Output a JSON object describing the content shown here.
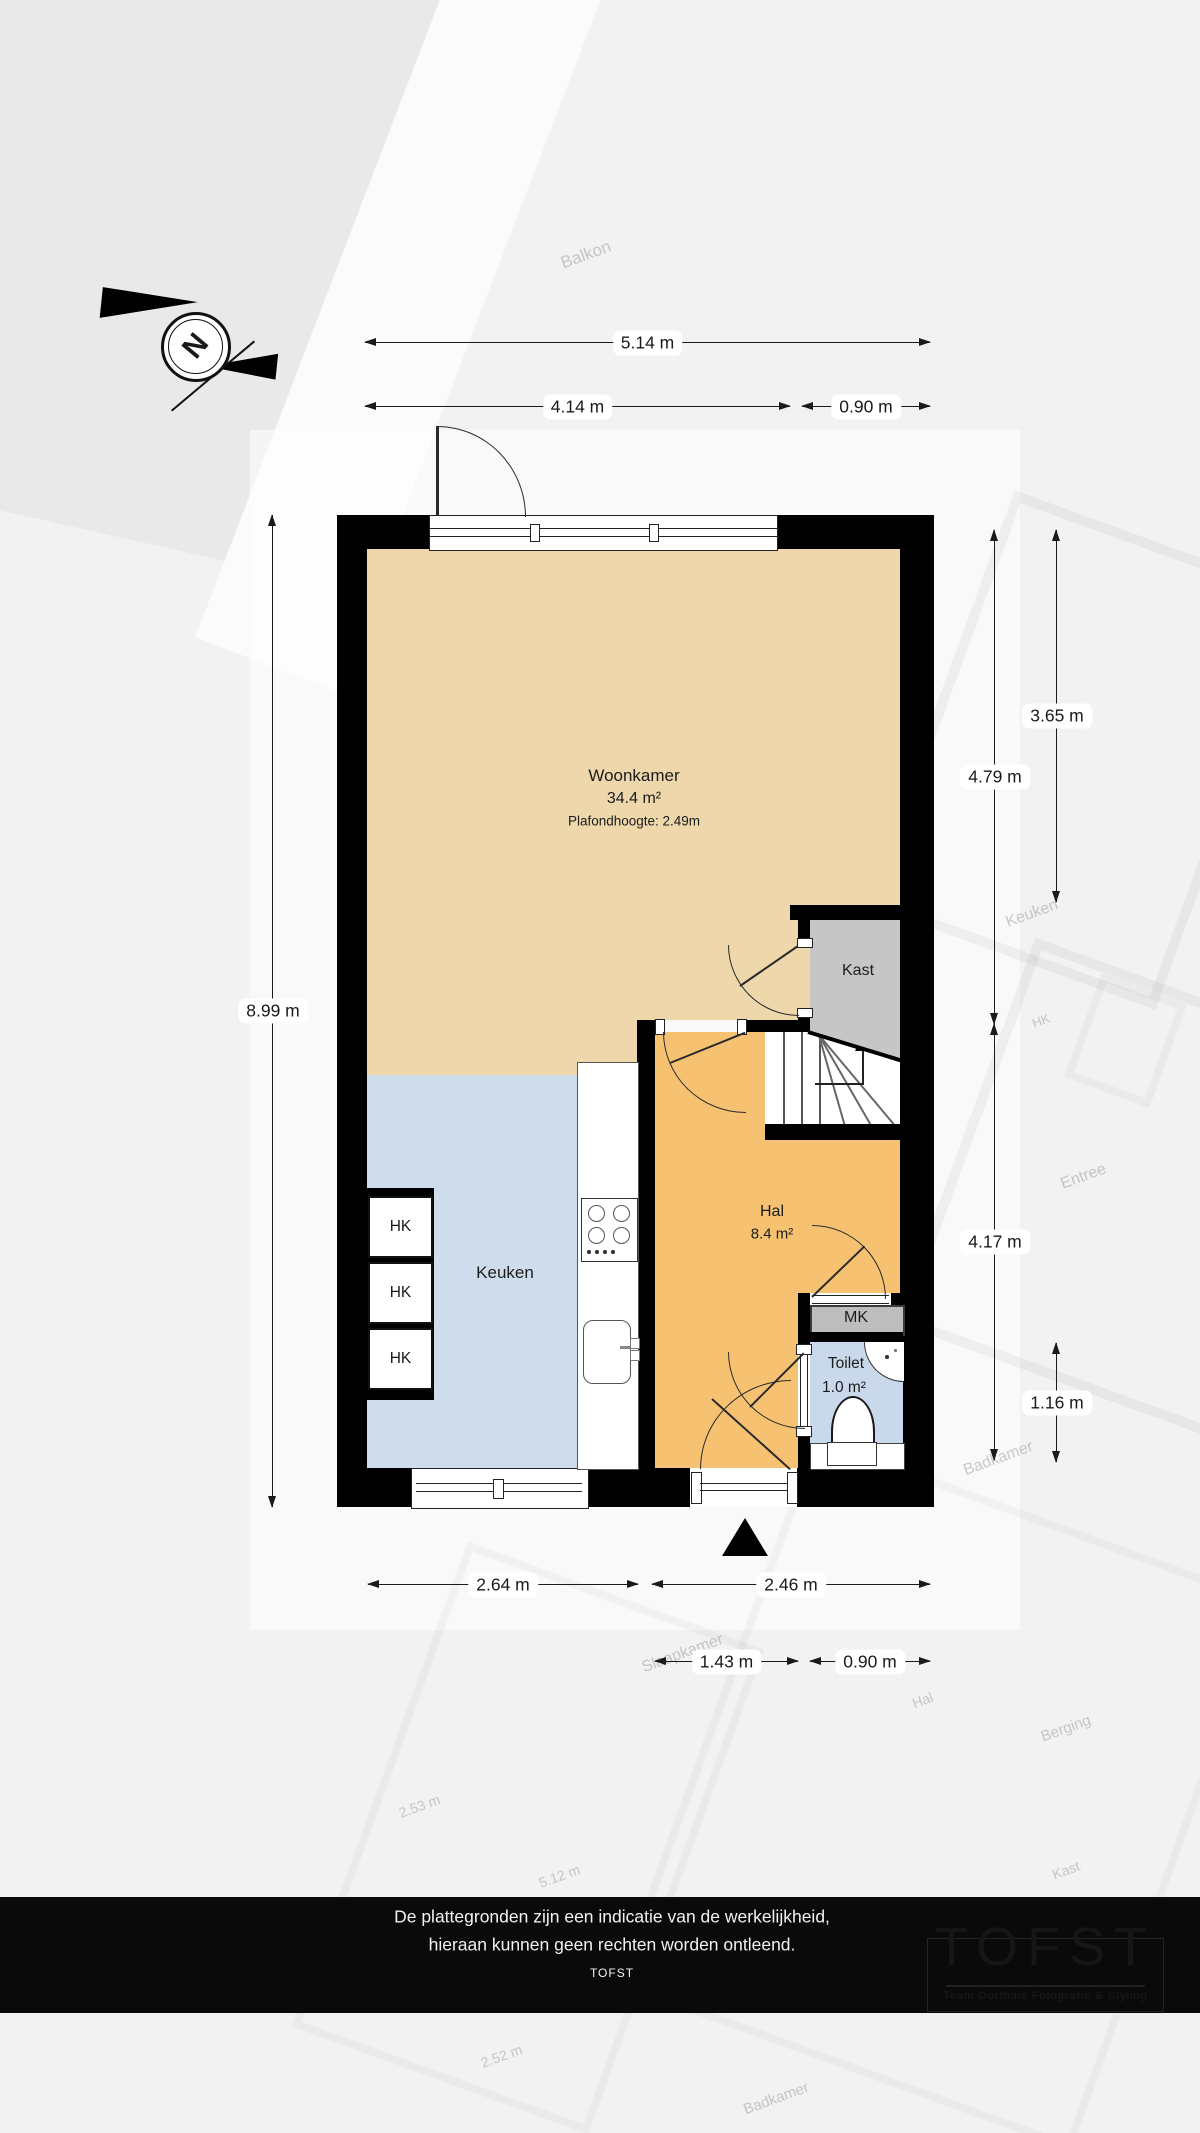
{
  "compass": {
    "north_letter": "N"
  },
  "plan": {
    "rooms": {
      "woonkamer": {
        "name": "Woonkamer",
        "area": "34.4 m²",
        "ceiling": "Plafondhoogte: 2.49m"
      },
      "kast": {
        "name": "Kast"
      },
      "keuken": {
        "name": "Keuken"
      },
      "hal": {
        "name": "Hal",
        "area": "8.4 m²"
      },
      "toilet": {
        "name": "Toilet",
        "area": "1.0 m²"
      },
      "mk": {
        "name": "MK"
      },
      "hk": {
        "name": "HK"
      }
    },
    "dimensions": {
      "width_total": "5.14 m",
      "width_window": "4.14 m",
      "width_door_top": "0.90 m",
      "height_total": "8.99 m",
      "height_woonkamer": "4.79 m",
      "height_right_upper": "3.65 m",
      "height_hal": "4.17 m",
      "height_toilet": "1.16 m",
      "width_keuken": "2.64 m",
      "width_hal": "2.46 m",
      "width_entry": "1.43 m",
      "width_door_bottom": "0.90 m"
    }
  },
  "background": {
    "labels": [
      {
        "text": "Balkon"
      },
      {
        "text": "Keuken"
      },
      {
        "text": "HK"
      },
      {
        "text": "Entree"
      },
      {
        "text": "Badkamer"
      },
      {
        "text": "Slaapkamer"
      },
      {
        "text": "Hal"
      },
      {
        "text": "Berging"
      },
      {
        "text": "Kast"
      },
      {
        "text": "2.53 m"
      },
      {
        "text": "5.12 m"
      },
      {
        "text": "2.52 m"
      },
      {
        "text": "Badkamer"
      }
    ]
  },
  "footer": {
    "disclaimer_line1": "De plattegronden zijn een indicatie van de werkelijkheid,",
    "disclaimer_line2": "hieraan kunnen geen rechten worden ontleend.",
    "brand": "TOFST",
    "logo_title": "TOFST",
    "logo_subtitle": "Team Oorthuis Fotografie & Styling"
  },
  "colors": {
    "woonkamer": "#edd7ab",
    "keuken": "#cfdcec",
    "hal": "#f6c272",
    "toilet": "#c9d9eb",
    "kast": "#c6c6c6",
    "wall": "#000000",
    "footer_bg": "#0a0a0a"
  }
}
